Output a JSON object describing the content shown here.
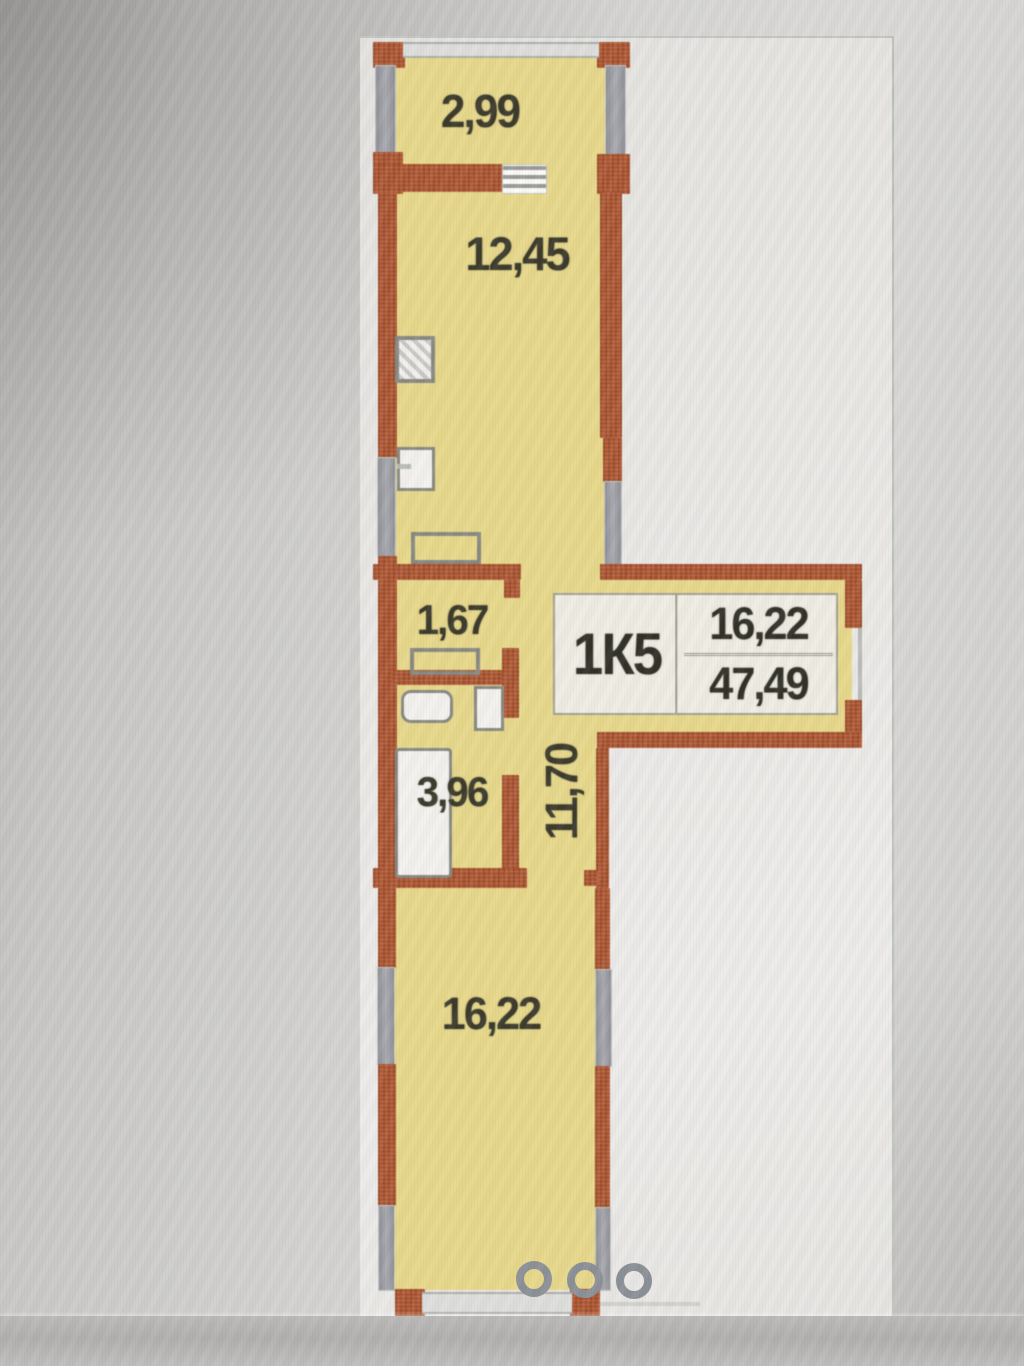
{
  "apartment": {
    "unit": "1К5",
    "living_area": "16,22",
    "total_area": "47,49"
  },
  "rooms": {
    "balcony": "2,99",
    "kitchen": "12,45",
    "storage": "1,67",
    "bathroom": "3,96",
    "hallway": "11,70",
    "living_room": "16,22"
  },
  "pagination": {
    "dot_count": 3
  },
  "colors": {
    "room_fill": "#e7d88c",
    "wall_brick": "#b25a35",
    "window_gray": "#9da0a5",
    "label_text": "#3a392c",
    "page_bg": "#e9e7e3",
    "dot_gray": "#8d9298"
  }
}
